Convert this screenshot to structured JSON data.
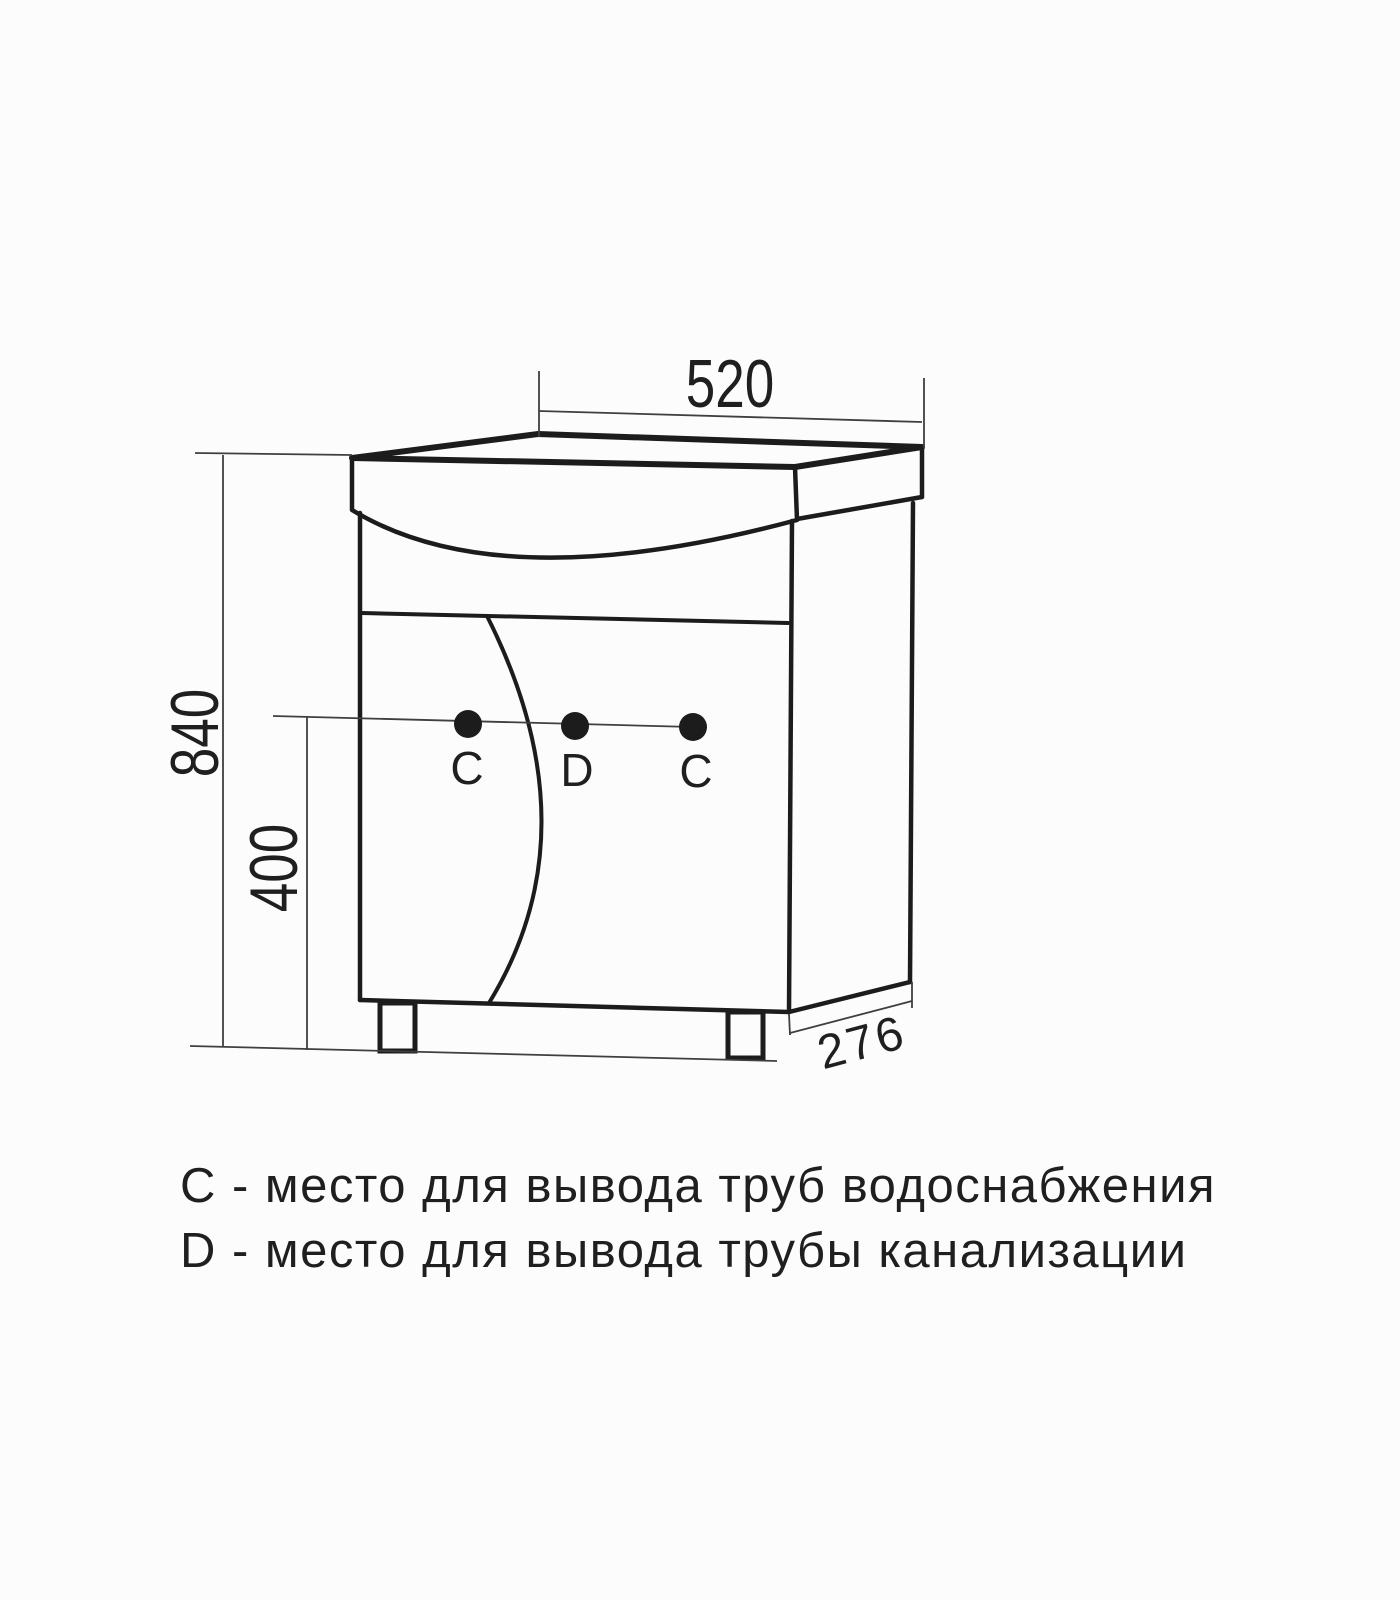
{
  "colors": {
    "line": "#1c1c1c",
    "dim_line": "#3f3f3f",
    "text": "#1f1f1f",
    "bg": "#fcfcfc"
  },
  "dimensions": {
    "top_width": "520",
    "total_height": "840",
    "holes_height": "400",
    "depth": "276"
  },
  "holes": {
    "left": "C",
    "center": "D",
    "right": "C"
  },
  "legend": {
    "line1": "C - место для вывода труб водоснабжения",
    "line2": "D - место для вывода трубы канализации"
  }
}
